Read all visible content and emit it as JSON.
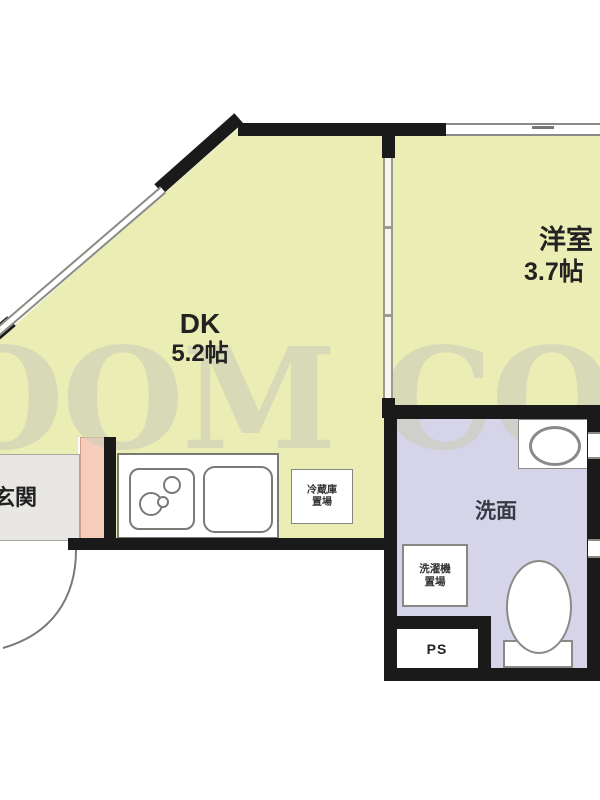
{
  "plan": {
    "watermark_text": "OOM COR",
    "rooms": {
      "dk": {
        "name": "DK",
        "size": "5.2帖"
      },
      "western": {
        "name": "洋室",
        "size": "3.7帖"
      },
      "washroom": {
        "name": "洗面"
      },
      "entrance": {
        "name": "玄関"
      }
    },
    "fixtures": {
      "fridge_space": {
        "line1": "冷蔵庫",
        "line2": "置場"
      },
      "washer_space": {
        "line1": "洗濯機",
        "line2": "置場"
      },
      "pipe_space": "PS"
    },
    "colors": {
      "room_yellow": "#ebeeb4",
      "washroom_purple": "#d5d4e8",
      "cabinet_pink": "#f6cdbb",
      "entrance_gray": "#e8e7e4",
      "wall_black": "#1a1a1a",
      "watermark_gray": "#cbccba"
    }
  }
}
